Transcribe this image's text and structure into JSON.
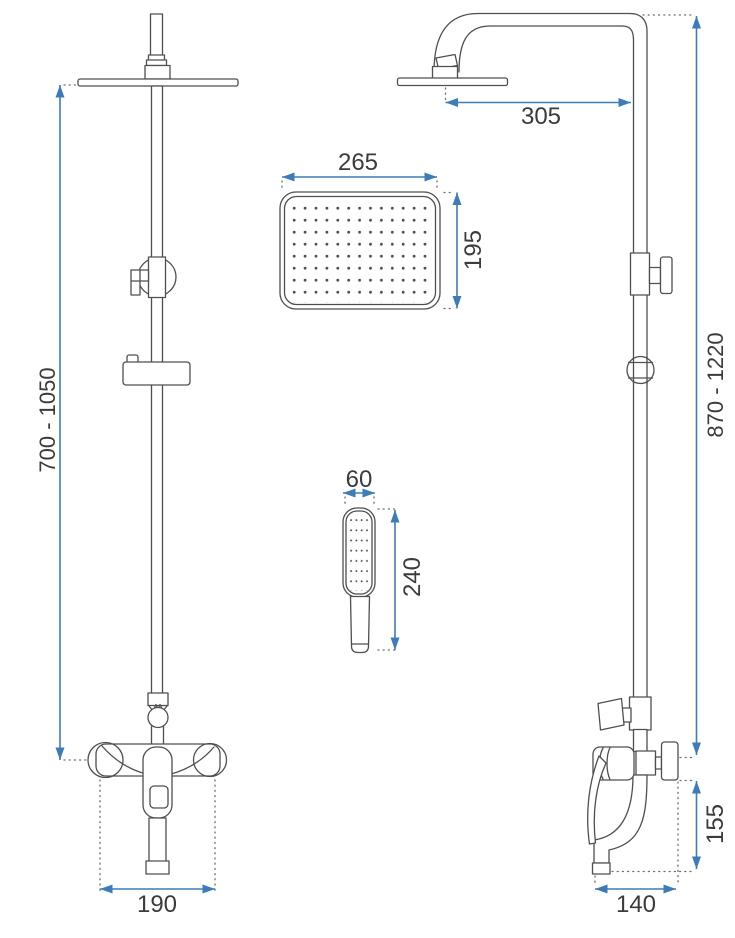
{
  "drawing": {
    "background": "#ffffff",
    "outline_color": "#4f4f4f",
    "dimension_color": "#3d7cb8",
    "extension_color": "#6e6e6e",
    "label_color": "#3b3b3b"
  },
  "dimensions": {
    "front_height_range": "700 - 1050",
    "front_base_width": "190",
    "head_width": "265",
    "head_depth": "195",
    "hand_shower_width": "60",
    "hand_shower_length": "240",
    "arm_reach": "305",
    "side_height_range": "870 - 1220",
    "spout_height": "155",
    "side_base_depth": "140"
  }
}
